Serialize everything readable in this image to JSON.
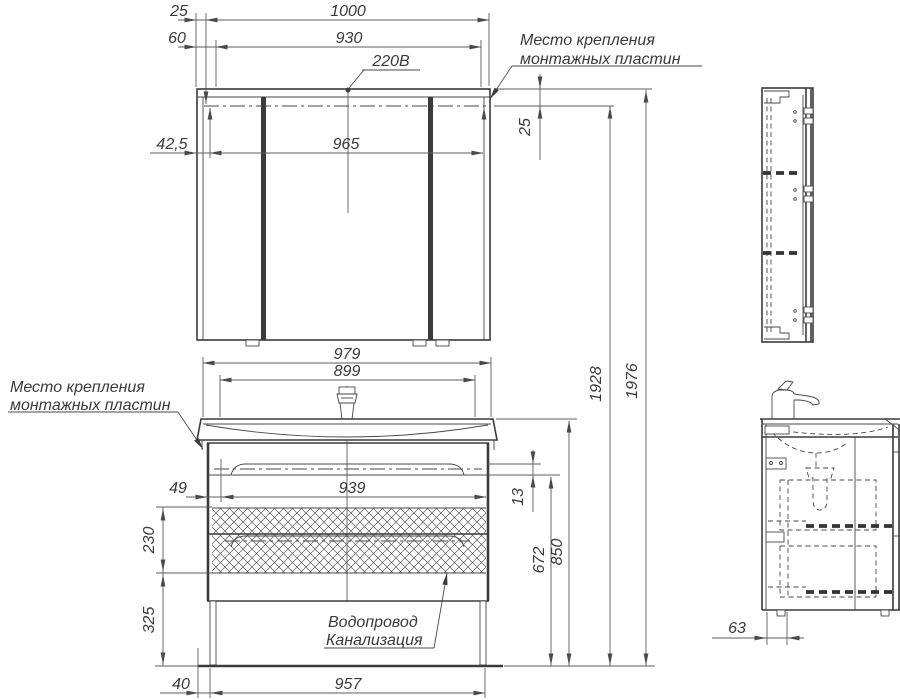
{
  "page": {
    "background": "#ffffff",
    "line_color": "#3b3b3b",
    "dim_color": "#5d5d5d"
  },
  "notes": {
    "mount_top": {
      "line1": "Место крепления",
      "line2": "монтажных пластин"
    },
    "mount_left": {
      "line1": "Место крепления",
      "line2": "монтажных пластин"
    },
    "plumbing": {
      "line1": "Водопровод",
      "line2": "Канализация"
    },
    "power": "220В"
  },
  "dimensions_mm": {
    "top_offset": "25",
    "mirror_width": "1000",
    "side_offset": "60",
    "span_930": "930",
    "edge_42_5": "42,5",
    "span_965": "965",
    "plate_depth": "25",
    "height_to_plate": "1928",
    "height_overall": "1976",
    "vanity_width": "979",
    "basin_width": "899",
    "drawer_span": "939",
    "edge_49": "49",
    "gap_13": "13",
    "drawer_height": "230",
    "bottom_clearance": "325",
    "cabinet_height": "672",
    "sink_height": "850",
    "leg_inset": "40",
    "base_width": "957",
    "wall_offset": "63"
  }
}
